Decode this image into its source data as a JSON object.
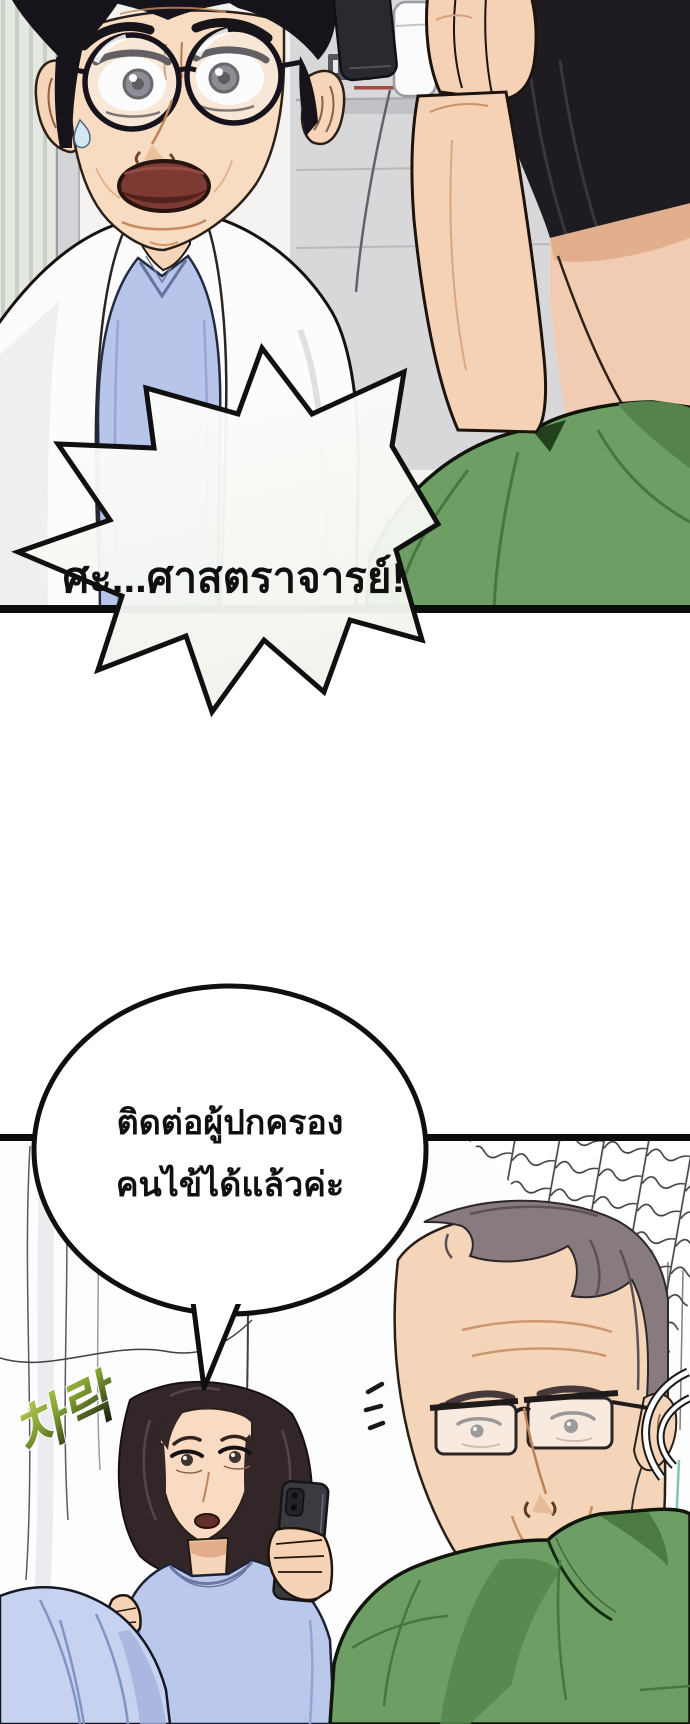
{
  "page": {
    "kind": "comic-page",
    "background": "#ffffff",
    "panel_count": 2
  },
  "panel1": {
    "sign_label": "2",
    "speech_bubble": {
      "text": "ศะ...ศาสตราจารย์!"
    }
  },
  "panel2": {
    "speech_bubble": {
      "line1": "ติดต่อผู้ปกครอง",
      "line2": "คนไข้ได้แล้วค่ะ"
    },
    "sfx": {
      "text": "차락"
    }
  },
  "colors": {
    "panel_border": "#0d0d0d",
    "scrub_green": "#6d9f65",
    "scrub_green_shadow": "#47773f",
    "scrub_blue": "#b9c6ec",
    "scrub_blue_light": "#c6d2ef",
    "skin": "#f6d5ba",
    "skin_shadow": "#e2ac8a",
    "hair_black": "#1e1b21",
    "hair_gray_brown": "#877b7f",
    "hair_dark_brown": "#322629",
    "mouth_red": "#7d3a33",
    "sign_gray": "#53565e",
    "sfx_green_light": "#c3d65c",
    "sfx_green_dark": "#1c260f",
    "teal_accent": "#2f9e90"
  }
}
